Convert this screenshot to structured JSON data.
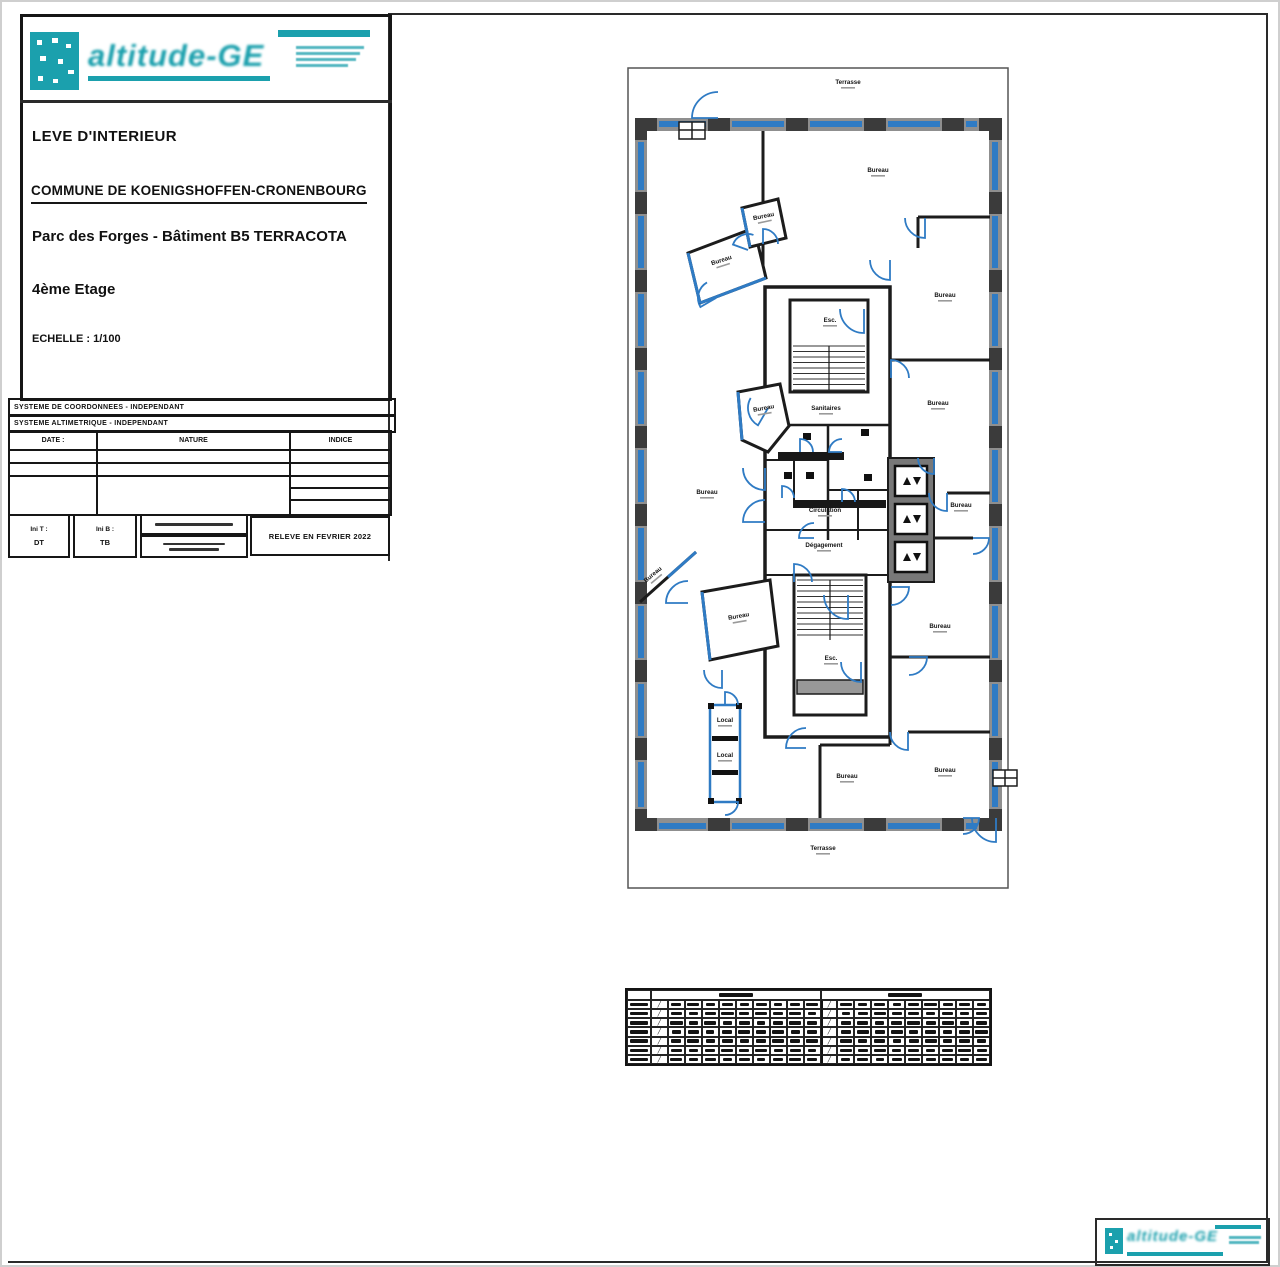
{
  "colors": {
    "accent_teal": "#1ba0ad",
    "plan_blue": "#2f7bc4",
    "wall_gray": "#8f8f8f"
  },
  "brand": {
    "wordmark": "altitude-GE"
  },
  "title_block": {
    "doc_type": "LEVE D'INTERIEUR",
    "commune": "COMMUNE DE KOENIGSHOFFEN-CRONENBOURG",
    "project": "Parc des Forges - Bâtiment B5 TERRACOTA",
    "floor": "4ème Etage",
    "scale": "ECHELLE : 1/100"
  },
  "systems": {
    "coordinates": "SYSTEME DE COORDONNEES - INDEPENDANT",
    "altimetry": "SYSTEME ALTIMETRIQUE - INDEPENDANT"
  },
  "revision_table": {
    "headers": {
      "date": "DATE :",
      "nature": "NATURE",
      "indice": "INDICE"
    }
  },
  "footer": {
    "ini_t_label": "Ini T :",
    "ini_t_value": "DT",
    "ini_b_label": "Ini B :",
    "ini_b_value": "TB",
    "survey": "RELEVE EN FEVRIER 2022"
  },
  "floor_plan": {
    "labels": [
      "Terrasse",
      "Bureau",
      "Bureau",
      "Bureau",
      "Bureau",
      "Esc.",
      "Sanitaires",
      "Bureau",
      "Bureau",
      "Circulation",
      "Dégagement",
      "Bureau",
      "Bureau",
      "Bureau",
      "Bureau",
      "Bureau",
      "Esc.",
      "Local",
      "Local",
      "Bureau",
      "Bureau",
      "Terrasse"
    ]
  },
  "areas_table": {
    "rows": 7,
    "cols": 20,
    "groups": 2
  }
}
